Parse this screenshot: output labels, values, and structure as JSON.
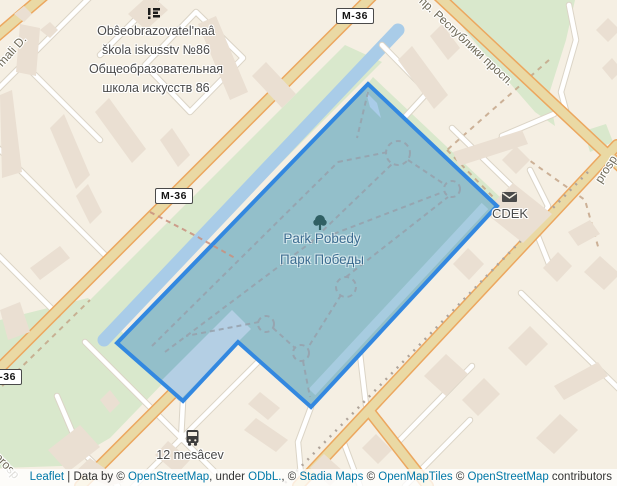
{
  "map_labels": {
    "school": {
      "lines": [
        "Obŝeobrazovatel'naâ",
        "škola iskusstv №86",
        "Общеобразовательная",
        "школа искусств 86"
      ]
    },
    "park": {
      "name_latin": "Park Pobedy",
      "name_cyrillic": "Парк Победы"
    },
    "cdek": "CDEK",
    "bus_stop": "12 mesâcev",
    "road_shield": "M-36",
    "streets": {
      "respubliki": "пр. Республики просп.",
      "prosp_bottom_left": "prosp",
      "prosp_right": "prosp",
      "mali_top_left": "mali D."
    }
  },
  "attribution": {
    "parts": [
      {
        "text": "Leaflet",
        "type": "link"
      },
      {
        "text": " | Data by © ",
        "type": "text"
      },
      {
        "text": "OpenStreetMap",
        "type": "link"
      },
      {
        "text": ", under ",
        "type": "text"
      },
      {
        "text": "ODbL.",
        "type": "link"
      },
      {
        "text": ", © ",
        "type": "text"
      },
      {
        "text": "Stadia Maps",
        "type": "link"
      },
      {
        "text": " © ",
        "type": "text"
      },
      {
        "text": "OpenMapTiles",
        "type": "link"
      },
      {
        "text": " © ",
        "type": "text"
      },
      {
        "text": "OpenStreetMap",
        "type": "link"
      },
      {
        "text": " contributors",
        "type": "text"
      }
    ]
  },
  "colors": {
    "park_selection_border": "#3388e0",
    "park_selection_fill": "#93bfca",
    "water": "#a9cce8",
    "major_road": "#ead9a4",
    "major_road_casing": "#eca75f",
    "green_area": "#d9e8cc",
    "land": "#f5efe3",
    "building": "#eadfd2",
    "attribution_link": "#0078a8"
  }
}
